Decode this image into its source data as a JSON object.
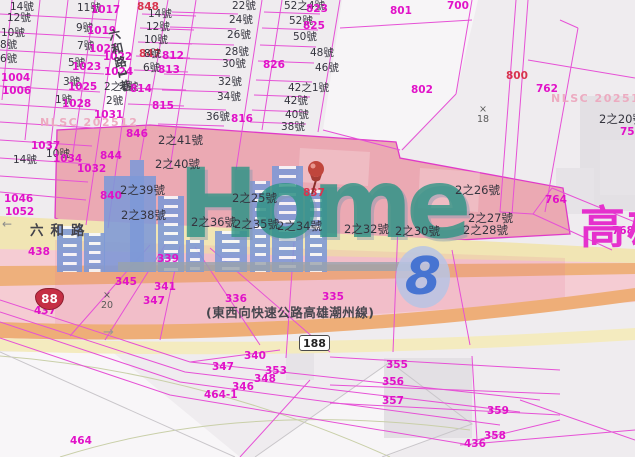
{
  "map": {
    "city_label": {
      "text": "高雄"
    },
    "watermark": {
      "brand": "Home",
      "number": "8",
      "agency_left": "NLSC 202512",
      "agency_right": "NLSC 202512",
      "buildings": [
        {
          "x": 57,
          "y": 226,
          "w": 25,
          "h": 46,
          "win": true
        },
        {
          "x": 84,
          "y": 233,
          "w": 21,
          "h": 39,
          "win": true
        },
        {
          "x": 104,
          "y": 176,
          "w": 52,
          "h": 96,
          "win": false
        },
        {
          "x": 130,
          "y": 160,
          "w": 14,
          "h": 112,
          "win": false
        },
        {
          "x": 158,
          "y": 196,
          "w": 26,
          "h": 76,
          "win": true
        },
        {
          "x": 186,
          "y": 240,
          "w": 18,
          "h": 32,
          "win": true
        },
        {
          "x": 215,
          "y": 231,
          "w": 32,
          "h": 41,
          "win": true
        },
        {
          "x": 250,
          "y": 181,
          "w": 20,
          "h": 91,
          "win": true
        },
        {
          "x": 272,
          "y": 166,
          "w": 31,
          "h": 106,
          "win": true
        },
        {
          "x": 305,
          "y": 190,
          "w": 22,
          "h": 82,
          "win": true
        }
      ]
    },
    "shields": [
      {
        "type": "expressway-shield",
        "text": "88"
      },
      {
        "type": "county-road-shield",
        "text": "188"
      }
    ],
    "labels": [
      {
        "t": "14號",
        "x": 10,
        "y": 2,
        "c": "house-sm"
      },
      {
        "t": "12號",
        "x": 7,
        "y": 13,
        "c": "house-sm"
      },
      {
        "t": "10號",
        "x": 1,
        "y": 28,
        "c": "house-sm"
      },
      {
        "t": "8號",
        "x": 0,
        "y": 40,
        "c": "house-sm"
      },
      {
        "t": "6號",
        "x": 0,
        "y": 54,
        "c": "house-sm"
      },
      {
        "t": "1004",
        "x": 1,
        "y": 73,
        "c": "parcel"
      },
      {
        "t": "1006",
        "x": 2,
        "y": 86,
        "c": "parcel"
      },
      {
        "t": "11號",
        "x": 77,
        "y": 3,
        "c": "house-sm"
      },
      {
        "t": "1017",
        "x": 91,
        "y": 5,
        "c": "parcel"
      },
      {
        "t": "9號",
        "x": 76,
        "y": 23,
        "c": "house-sm"
      },
      {
        "t": "1019",
        "x": 87,
        "y": 26,
        "c": "parcel"
      },
      {
        "t": "7號",
        "x": 77,
        "y": 41,
        "c": "house-sm"
      },
      {
        "t": "1021",
        "x": 89,
        "y": 44,
        "c": "parcel"
      },
      {
        "t": "5號",
        "x": 68,
        "y": 58,
        "c": "house-sm"
      },
      {
        "t": "1023",
        "x": 72,
        "y": 62,
        "c": "parcel"
      },
      {
        "t": "3號",
        "x": 63,
        "y": 77,
        "c": "house-sm"
      },
      {
        "t": "1025",
        "x": 68,
        "y": 82,
        "c": "parcel"
      },
      {
        "t": "1號",
        "x": 55,
        "y": 95,
        "c": "house-sm"
      },
      {
        "t": "1028",
        "x": 62,
        "y": 99,
        "c": "parcel"
      },
      {
        "t": "1031",
        "x": 94,
        "y": 110,
        "c": "parcel"
      },
      {
        "t": "1022",
        "x": 103,
        "y": 52,
        "c": "parcel"
      },
      {
        "t": "1024",
        "x": 104,
        "y": 67,
        "c": "parcel"
      },
      {
        "t": "848",
        "x": 137,
        "y": 2,
        "c": "red"
      },
      {
        "t": "847",
        "x": 139,
        "y": 49,
        "c": "red"
      },
      {
        "t": "14號",
        "x": 148,
        "y": 9,
        "c": "house-sm"
      },
      {
        "t": "12號",
        "x": 146,
        "y": 22,
        "c": "house-sm"
      },
      {
        "t": "10號",
        "x": 144,
        "y": 35,
        "c": "house-sm"
      },
      {
        "t": "8號",
        "x": 144,
        "y": 49,
        "c": "house-sm"
      },
      {
        "t": "812",
        "x": 162,
        "y": 51,
        "c": "parcel"
      },
      {
        "t": "6號",
        "x": 143,
        "y": 63,
        "c": "house-sm"
      },
      {
        "t": "813",
        "x": 158,
        "y": 65,
        "c": "parcel"
      },
      {
        "t": "2之1號",
        "x": 104,
        "y": 82,
        "c": "house-sm"
      },
      {
        "t": "814",
        "x": 130,
        "y": 84,
        "c": "parcel"
      },
      {
        "t": "2號",
        "x": 106,
        "y": 96,
        "c": "house-sm"
      },
      {
        "t": "815",
        "x": 152,
        "y": 101,
        "c": "parcel"
      },
      {
        "t": "22號",
        "x": 232,
        "y": 1,
        "c": "house-sm"
      },
      {
        "t": "24號",
        "x": 229,
        "y": 15,
        "c": "house-sm"
      },
      {
        "t": "26號",
        "x": 227,
        "y": 30,
        "c": "house-sm"
      },
      {
        "t": "28號",
        "x": 225,
        "y": 47,
        "c": "house-sm"
      },
      {
        "t": "30號",
        "x": 222,
        "y": 59,
        "c": "house-sm"
      },
      {
        "t": "32號",
        "x": 218,
        "y": 77,
        "c": "house-sm"
      },
      {
        "t": "34號",
        "x": 217,
        "y": 92,
        "c": "house-sm"
      },
      {
        "t": "36號",
        "x": 206,
        "y": 112,
        "c": "house-sm"
      },
      {
        "t": "816",
        "x": 231,
        "y": 114,
        "c": "parcel"
      },
      {
        "t": "826",
        "x": 263,
        "y": 60,
        "c": "parcel"
      },
      {
        "t": "52之4號",
        "x": 284,
        "y": 1,
        "c": "house-sm"
      },
      {
        "t": "823",
        "x": 306,
        "y": 4,
        "c": "parcel"
      },
      {
        "t": "52號",
        "x": 289,
        "y": 16,
        "c": "house-sm"
      },
      {
        "t": "825",
        "x": 303,
        "y": 21,
        "c": "parcel"
      },
      {
        "t": "50號",
        "x": 293,
        "y": 32,
        "c": "house-sm"
      },
      {
        "t": "48號",
        "x": 310,
        "y": 48,
        "c": "house-sm"
      },
      {
        "t": "46號",
        "x": 315,
        "y": 63,
        "c": "house-sm"
      },
      {
        "t": "42之1號",
        "x": 288,
        "y": 83,
        "c": "house-sm"
      },
      {
        "t": "42號",
        "x": 284,
        "y": 96,
        "c": "house-sm"
      },
      {
        "t": "40號",
        "x": 285,
        "y": 110,
        "c": "house-sm"
      },
      {
        "t": "38號",
        "x": 281,
        "y": 122,
        "c": "house-sm"
      },
      {
        "t": "801",
        "x": 390,
        "y": 6,
        "c": "parcel"
      },
      {
        "t": "700",
        "x": 447,
        "y": 1,
        "c": "parcel"
      },
      {
        "t": "802",
        "x": 411,
        "y": 85,
        "c": "parcel"
      },
      {
        "t": "800",
        "x": 506,
        "y": 71,
        "c": "red"
      },
      {
        "t": "762",
        "x": 536,
        "y": 84,
        "c": "parcel"
      },
      {
        "t": "2之20號",
        "x": 599,
        "y": 113,
        "c": "house"
      },
      {
        "t": "758",
        "x": 620,
        "y": 127,
        "c": "parcel"
      },
      {
        "t": "764",
        "x": 545,
        "y": 195,
        "c": "parcel"
      },
      {
        "t": "768",
        "x": 612,
        "y": 226,
        "c": "parcel"
      },
      {
        "t": "846",
        "x": 126,
        "y": 129,
        "c": "parcel"
      },
      {
        "t": "844",
        "x": 100,
        "y": 151,
        "c": "parcel"
      },
      {
        "t": "840",
        "x": 100,
        "y": 191,
        "c": "parcel"
      },
      {
        "t": "1037",
        "x": 31,
        "y": 141,
        "c": "parcel"
      },
      {
        "t": "14號",
        "x": 13,
        "y": 155,
        "c": "house-sm"
      },
      {
        "t": "10號",
        "x": 46,
        "y": 149,
        "c": "house-sm"
      },
      {
        "t": "1034",
        "x": 53,
        "y": 154,
        "c": "parcel"
      },
      {
        "t": "1032",
        "x": 77,
        "y": 164,
        "c": "parcel"
      },
      {
        "t": "1046",
        "x": 4,
        "y": 194,
        "c": "parcel"
      },
      {
        "t": "1052",
        "x": 5,
        "y": 207,
        "c": "parcel"
      },
      {
        "t": "2之41號",
        "x": 158,
        "y": 134,
        "c": "house"
      },
      {
        "t": "2之40號",
        "x": 155,
        "y": 158,
        "c": "house"
      },
      {
        "t": "2之39號",
        "x": 120,
        "y": 184,
        "c": "house"
      },
      {
        "t": "2之38號",
        "x": 121,
        "y": 209,
        "c": "house"
      },
      {
        "t": "2之25號",
        "x": 232,
        "y": 192,
        "c": "house"
      },
      {
        "t": "2之36號",
        "x": 191,
        "y": 216,
        "c": "house"
      },
      {
        "t": "2之35號",
        "x": 234,
        "y": 218,
        "c": "house"
      },
      {
        "t": "2之34號",
        "x": 277,
        "y": 220,
        "c": "house"
      },
      {
        "t": "2之32號",
        "x": 344,
        "y": 223,
        "c": "house"
      },
      {
        "t": "2之30號",
        "x": 395,
        "y": 225,
        "c": "house"
      },
      {
        "t": "2之26號",
        "x": 455,
        "y": 184,
        "c": "house"
      },
      {
        "t": "2之27號",
        "x": 468,
        "y": 212,
        "c": "house"
      },
      {
        "t": "2之28號",
        "x": 463,
        "y": 224,
        "c": "house"
      },
      {
        "t": "837",
        "x": 303,
        "y": 188,
        "c": "red"
      },
      {
        "t": "438",
        "x": 28,
        "y": 247,
        "c": "parcel"
      },
      {
        "t": "339",
        "x": 157,
        "y": 254,
        "c": "parcel"
      },
      {
        "t": "345",
        "x": 115,
        "y": 277,
        "c": "parcel"
      },
      {
        "t": "341",
        "x": 154,
        "y": 282,
        "c": "parcel"
      },
      {
        "t": "347",
        "x": 143,
        "y": 296,
        "c": "parcel"
      },
      {
        "t": "437",
        "x": 34,
        "y": 306,
        "c": "parcel"
      },
      {
        "t": "336",
        "x": 225,
        "y": 294,
        "c": "parcel"
      },
      {
        "t": "335",
        "x": 322,
        "y": 292,
        "c": "parcel"
      },
      {
        "t": "340",
        "x": 244,
        "y": 351,
        "c": "parcel"
      },
      {
        "t": "347",
        "x": 212,
        "y": 362,
        "c": "parcel"
      },
      {
        "t": "353",
        "x": 265,
        "y": 366,
        "c": "parcel"
      },
      {
        "t": "348",
        "x": 254,
        "y": 374,
        "c": "parcel"
      },
      {
        "t": "346",
        "x": 232,
        "y": 382,
        "c": "parcel"
      },
      {
        "t": "464-1",
        "x": 204,
        "y": 390,
        "c": "parcel"
      },
      {
        "t": "464",
        "x": 70,
        "y": 436,
        "c": "parcel"
      },
      {
        "t": "355",
        "x": 386,
        "y": 360,
        "c": "parcel"
      },
      {
        "t": "356",
        "x": 382,
        "y": 377,
        "c": "parcel"
      },
      {
        "t": "357",
        "x": 382,
        "y": 396,
        "c": "parcel"
      },
      {
        "t": "359",
        "x": 487,
        "y": 406,
        "c": "parcel"
      },
      {
        "t": "358",
        "x": 484,
        "y": 431,
        "c": "parcel"
      },
      {
        "t": "436",
        "x": 464,
        "y": 439,
        "c": "parcel"
      },
      {
        "t": "×",
        "x": 479,
        "y": 105,
        "c": "marker"
      },
      {
        "t": "18",
        "x": 477,
        "y": 115,
        "c": "marker"
      },
      {
        "t": "×",
        "x": 103,
        "y": 291,
        "c": "marker"
      },
      {
        "t": "20",
        "x": 101,
        "y": 301,
        "c": "marker"
      },
      {
        "t": "六和路",
        "x": 30,
        "y": 224,
        "c": "roadname"
      },
      {
        "t": "六和路1巷",
        "x": 113,
        "y": 28,
        "c": "lane"
      },
      {
        "t": "(東西向快速公路高雄潮州線)",
        "x": 206,
        "y": 306,
        "c": "roadname-ex"
      },
      {
        "t": "NLSC 202512",
        "x": 40,
        "y": 117,
        "c": "wm"
      },
      {
        "t": "NLSC 202512",
        "x": 551,
        "y": 93,
        "c": "wm"
      }
    ]
  }
}
